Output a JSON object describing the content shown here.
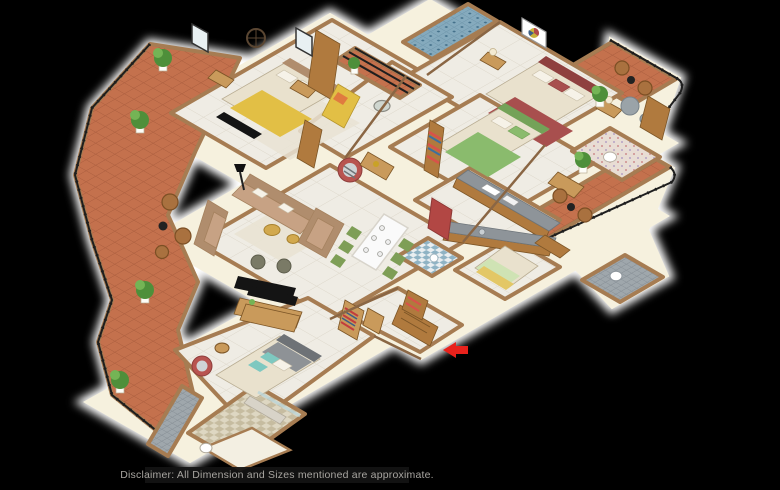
{
  "disclaimer": {
    "text": "Disclaimer: All Dimension and Sizes mentioned are approximate."
  },
  "palette": {
    "bg": "#000000",
    "wallCream": "#f6f1de",
    "wallEdge": "#a67c52",
    "wallEdgeDark": "#8a6644",
    "marble": "#efece4",
    "marbleLine": "#dcd6c9",
    "terracotta": "#c4714d",
    "terracottaLine": "#a85c3d",
    "tileBlue": "#85aabd",
    "tileBlueDark": "#44708a",
    "tileBeige": "#ded7c2",
    "tileBeige2": "#c6bca0",
    "tileGrey": "#9fa7ac",
    "tileGreyDark": "#7c858c",
    "railing": "#1e1e1e",
    "woodMid": "#b07a3e",
    "woodLight": "#c99a5b",
    "woodDark": "#7c5526",
    "mattress": "#e9e1cd",
    "bedYellow": "#e2bf45",
    "bedMaroon": "#a84f4e",
    "bedMaroonDark": "#8f403f",
    "bedGreen": "#8abb6d",
    "bedGreenDark": "#74a258",
    "bedGrey": "#8e9296",
    "headboardGrey": "#6e7276",
    "sofaTan": "#c7a284",
    "sofaDark": "#b08d6d",
    "chairRed": "#b85450",
    "chairGreen": "#7e9e56",
    "gold": "#d2a94e",
    "rug": "#e9e3d3",
    "counterGrey": "#8e9499",
    "fridgeRed": "#b24744",
    "plantGreen": "#4e8f3a",
    "plantLite": "#74b455",
    "wicker": "#a9713f",
    "wickerDark": "#7c4f24",
    "accentArrow": "#e8221c",
    "glow": "#ffffff",
    "barBg": "#141414",
    "barText": "#b5b2ad"
  },
  "scene": {
    "type": "3d-isometric-apartment-floor-plan",
    "view": "isometric top-down render on black background with white outline glow",
    "entry_marker": "red arrow pointing to main entrance door",
    "rooms": [
      {
        "name": "bedroom-top-left",
        "floor": "white marble",
        "furniture": [
          "double bed with yellow blanket",
          "wall clock",
          "two nightstands",
          "wardrobe",
          "tv panel",
          "rug",
          "windows"
        ]
      },
      {
        "name": "balcony-left",
        "floor": "terracotta tile",
        "furniture": [
          "potted plants",
          "wicker chairs",
          "round side table",
          "black metal railing"
        ]
      },
      {
        "name": "bathroom-top",
        "floor": "blue mosaic tile",
        "furniture": [
          "window"
        ]
      },
      {
        "name": "bedroom-top-right",
        "floor": "white marble",
        "furniture": [
          "double bed with maroon bedding",
          "framed artwork",
          "nightstands with lamps",
          "grey armchair",
          "dresser"
        ]
      },
      {
        "name": "balcony-top-right",
        "floor": "terracotta tile",
        "furniture": [
          "wicker chairs",
          "side table",
          "potted plant",
          "black metal railing"
        ]
      },
      {
        "name": "bedroom-right",
        "floor": "white marble",
        "furniture": [
          "double bed with green bedding",
          "bookshelf",
          "vanity"
        ]
      },
      {
        "name": "bathroom-right",
        "floor": "floral tile",
        "furniture": [
          "toilet"
        ]
      },
      {
        "name": "balcony-right",
        "floor": "terracotta tile",
        "furniture": [
          "wicker chairs",
          "side table",
          "potted plant",
          "black metal railing"
        ]
      },
      {
        "name": "bathroom-right-lower",
        "floor": "grey mosaic tile",
        "furniture": [
          "toilet"
        ]
      },
      {
        "name": "living-room",
        "floor": "white marble",
        "furniture": [
          "three-seat sofa",
          "two armchairs",
          "rug",
          "gold coffee tables",
          "two poufs",
          "tv console",
          "floor lamp",
          "red lounge chair",
          "yellow bench",
          "round glass table"
        ]
      },
      {
        "name": "dining-area",
        "floor": "white marble",
        "furniture": [
          "white dining table with place settings",
          "six green chairs",
          "sideboard"
        ]
      },
      {
        "name": "kitchen",
        "floor": "white marble",
        "furniture": [
          "parallel grey counters",
          "red refrigerator",
          "hob",
          "oven",
          "sink"
        ]
      },
      {
        "name": "maid-room",
        "floor": "white marble",
        "furniture": [
          "single bed",
          "wardrobe"
        ]
      },
      {
        "name": "utility-bathroom",
        "floor": "blue checker tile",
        "furniture": [
          "washbasin"
        ]
      },
      {
        "name": "foyer",
        "floor": "white marble",
        "furniture": [
          "shoe racks with shoes",
          "bench",
          "main entrance door"
        ]
      },
      {
        "name": "master-bedroom",
        "floor": "white marble",
        "furniture": [
          "double bed with grey and teal bedding",
          "red accent chair",
          "round table",
          "desk with tv",
          "wardrobe",
          "foot bench"
        ]
      },
      {
        "name": "master-bathroom",
        "floor": "beige checker tile",
        "furniture": [
          "glass shower",
          "toilet"
        ]
      }
    ]
  }
}
